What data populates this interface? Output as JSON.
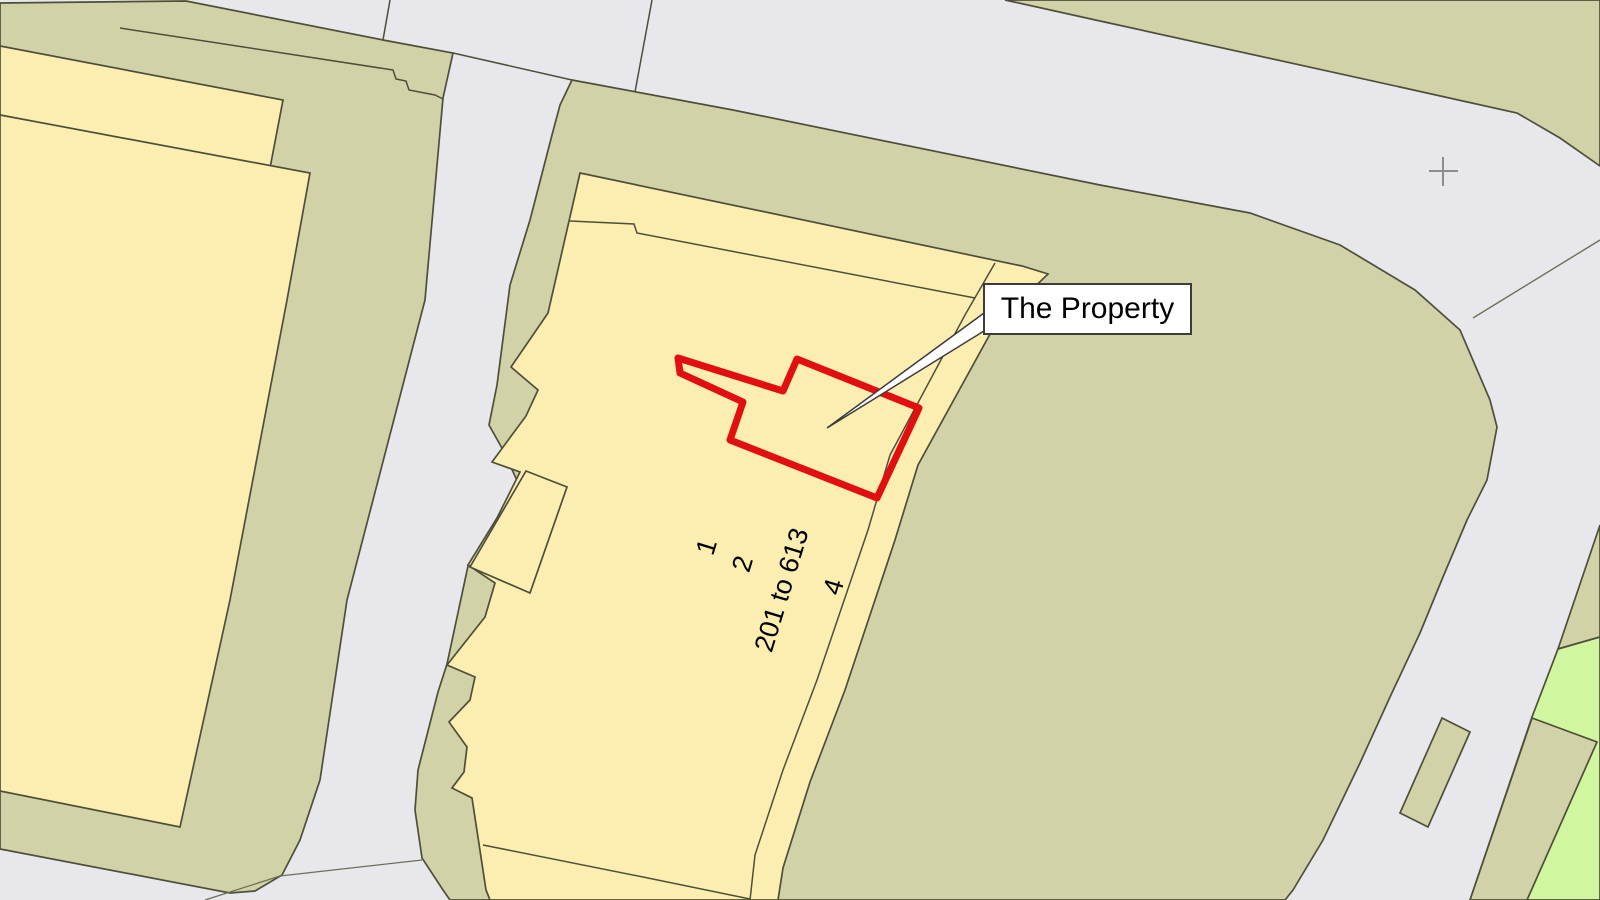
{
  "map": {
    "title": "Property location plan",
    "width": 1600,
    "height": 900,
    "colors": {
      "road": "#e8e8ec",
      "parcel": "#d2d2a8",
      "building": "#fceeb0",
      "green": "#d0f6a0",
      "line": "#4e4e3a",
      "faint": "#6e6e5a",
      "red": "#e10f0f",
      "cross": "#8c8c8c",
      "label_border": "#3c3c3c",
      "label_bg": "#ffffff"
    },
    "shapes": [
      {
        "name": "parcel-left-band",
        "type": "polygon",
        "points": "0,3 186,1 383,40 453,53 443,98 425,300 347,600 320,780 300,840 282,875 255,891 230,893 0,849",
        "fill": "parcel",
        "stroke": "line",
        "width": 1.7
      },
      {
        "name": "parcel-top-right",
        "type": "polygon",
        "points": "1005,0 1600,0 1600,166 1560,138 1517,113 1400,87 1100,21",
        "fill": "parcel",
        "stroke": "line",
        "width": 1.7
      },
      {
        "name": "parcel-central",
        "type": "polygon",
        "points": "572,80 733,110 1100,185 1250,213 1340,245 1415,290 1460,330 1490,400 1497,427 1487,480 1467,520 1443,577 1420,633 1390,697 1360,763 1323,840 1293,890 1285,900 450,900 443,890 422,858 415,810 418,770 438,692 447,664 468,566 497,521 520,487 503,450 489,425 497,385 510,285 530,220 552,135 560,105",
        "fill": "parcel",
        "stroke": "line",
        "width": 1.7
      },
      {
        "name": "parcel-wedge-right",
        "type": "polygon",
        "points": "1600,525 1558,649 1600,637",
        "fill": "parcel",
        "stroke": "line",
        "width": 1.7
      },
      {
        "name": "green-area",
        "type": "polygon",
        "points": "1558,649 1600,637 1600,900 1470,900 1532,717",
        "fill": "green",
        "stroke": "line",
        "width": 1.7
      },
      {
        "name": "parcel-strip-bottom-right",
        "type": "polygon",
        "points": "1532,718 1597,742 1527,900 1470,900",
        "fill": "parcel",
        "stroke": "line",
        "width": 1.7
      },
      {
        "name": "traffic-island",
        "type": "polygon",
        "points": "1442,718 1470,732 1428,827 1400,813",
        "fill": "parcel",
        "stroke": "line",
        "width": 1.7
      },
      {
        "name": "building-left-back",
        "type": "polygon",
        "points": "0,46 283,100 270,168 0,115",
        "fill": "building",
        "stroke": "line",
        "width": 1.7
      },
      {
        "name": "building-left-front",
        "type": "polygon",
        "points": "0,115 310,173 287,300 230,600 180,827 0,791",
        "fill": "building",
        "stroke": "line",
        "width": 1.7
      },
      {
        "name": "building-central",
        "type": "polygon",
        "points": "580,173 1022,266 1048,274 995,325 918,465 895,540 845,690 810,782 783,868 778,900 490,900 486,890 472,798 452,788 464,772 467,747 449,722 470,700 475,677 447,665 485,617 495,583 468,565 497,518 520,472 492,462 526,416 538,390 511,367 548,313",
        "fill": "building",
        "stroke": "line",
        "width": 1.7
      },
      {
        "name": "building-central-wing",
        "type": "polygon",
        "points": "526,471 567,487 530,593 470,567",
        "fill": "building",
        "stroke": "line",
        "width": 1.7
      },
      {
        "name": "road-junction-line-1",
        "type": "polyline",
        "points": "390,0 383,40",
        "stroke": "line",
        "width": 1.5
      },
      {
        "name": "road-edge-line",
        "type": "polyline",
        "points": "453,53 572,80",
        "stroke": "line",
        "width": 1.5
      },
      {
        "name": "road-junction-line-2",
        "type": "polyline",
        "points": "652,0 635,92",
        "stroke": "line",
        "width": 1.5
      },
      {
        "name": "parcel-inner-boundary",
        "type": "polyline",
        "points": "120,28 393,70 396,79 406,81 409,90 435,95 443,99",
        "stroke": "line",
        "width": 1.5
      },
      {
        "name": "building-inner-line",
        "type": "polyline",
        "points": "570,221 634,224 637,233 975,298",
        "stroke": "line",
        "width": 1.5
      },
      {
        "name": "building-right-edge",
        "type": "polyline",
        "points": "995,263 965,315 890,455 868,530 817,680 783,770 755,855 750,900",
        "stroke": "line",
        "width": 1.5
      },
      {
        "name": "building-bottom-line",
        "type": "polyline",
        "points": "483,845 643,877 750,899",
        "stroke": "line",
        "width": 1.5
      },
      {
        "name": "boundary-line-bottom-1",
        "type": "polyline",
        "points": "280,876 422,860",
        "stroke": "faint",
        "width": 1.3
      },
      {
        "name": "boundary-line-bottom-2",
        "type": "polyline",
        "points": "280,876 205,900",
        "stroke": "faint",
        "width": 1.3
      },
      {
        "name": "road-junction-line-3",
        "type": "polyline",
        "points": "1473,318 1600,240",
        "stroke": "faint",
        "width": 1.4
      },
      {
        "name": "property-outline",
        "type": "polygon",
        "points": "678,358 783,391 797,359 919,408 877,498 730,440 743,402 680,373",
        "fill": "none",
        "stroke": "red",
        "width": 7,
        "linejoin": "round"
      },
      {
        "name": "label-leader-line",
        "type": "polygon",
        "points": "984,313 984,331 827,428",
        "fill": "label_bg",
        "stroke": "label_border",
        "width": 1.5
      },
      {
        "name": "survey-cross-h",
        "type": "polyline",
        "points": "1429,171 1458,171",
        "stroke": "cross",
        "width": 2
      },
      {
        "name": "survey-cross-v",
        "type": "polyline",
        "points": "1443,157 1443,186",
        "stroke": "cross",
        "width": 2
      }
    ],
    "annotations": {
      "property_label": {
        "text": "The Property",
        "x": 983,
        "y": 283,
        "w": 209,
        "h": 52,
        "font_size": 30
      },
      "building_numbers": [
        {
          "text": "1",
          "x": 707,
          "y": 547,
          "rotation": -73,
          "font_size": 27
        },
        {
          "text": "2",
          "x": 743,
          "y": 564,
          "rotation": -73,
          "font_size": 27
        },
        {
          "text": "201 to 613",
          "x": 782,
          "y": 590,
          "rotation": -73,
          "font_size": 27
        },
        {
          "text": "4",
          "x": 834,
          "y": 587,
          "rotation": -73,
          "font_size": 27
        }
      ]
    }
  }
}
